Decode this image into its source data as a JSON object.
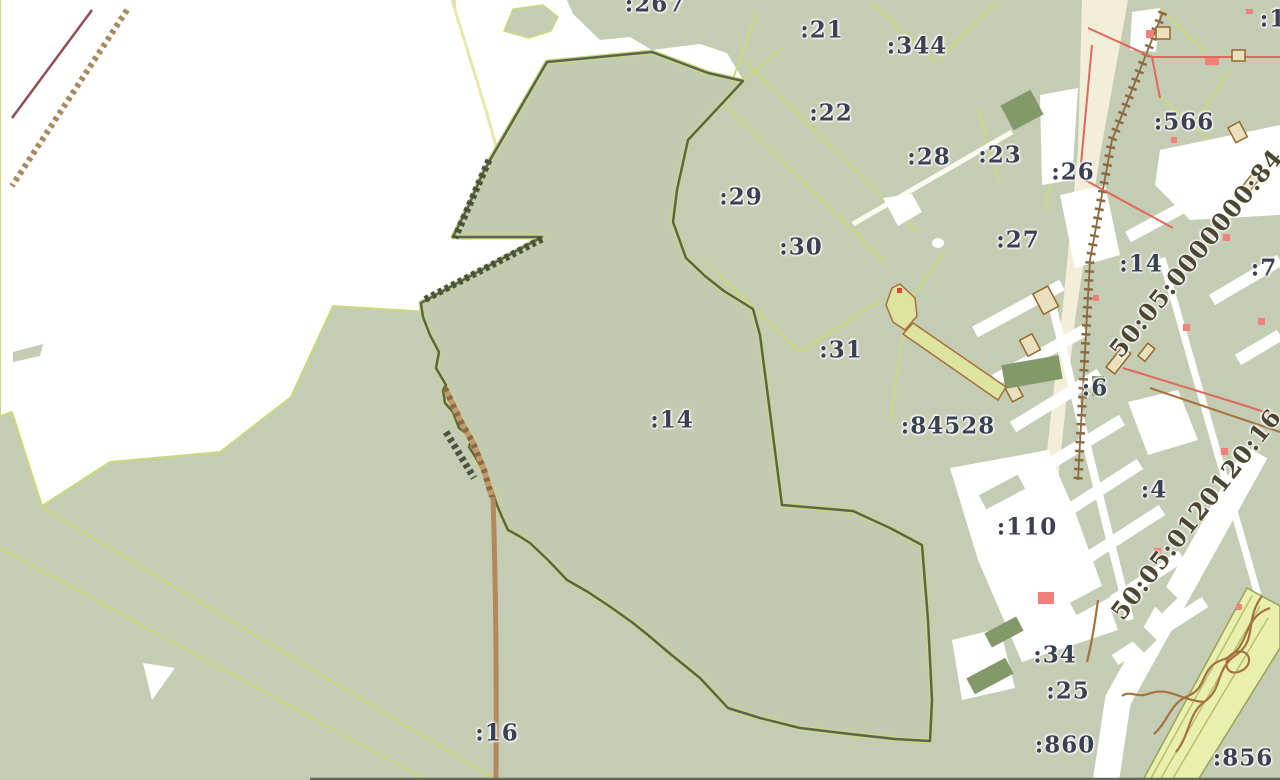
{
  "map": {
    "title": "cadastral-map-view",
    "selected_parcel": ":14",
    "palette": {
      "background": "#ffffff",
      "parcel_fill": "#c5ccb4",
      "parcel_boundary": "#ccd87c",
      "selected_outline": "#5a6354",
      "road_brown": "#b5885c",
      "road_cream": "#f3eed8",
      "railway_maroon": "#8f4e55",
      "building_pink": "#f4807b",
      "building_outline": "#96672e",
      "dark_green_block": "#83996a",
      "wide_band_fill": "#e9efad",
      "pipeline_brown": "#a5713c",
      "label_color": "#3a4153",
      "quarter_label_color": "#4c4733"
    },
    "labels": [
      {
        "text": ":267",
        "x": 655,
        "y": 4
      },
      {
        "text": ":21",
        "x": 822,
        "y": 30
      },
      {
        "text": ":344",
        "x": 917,
        "y": 46
      },
      {
        "text": ":22",
        "x": 831,
        "y": 113
      },
      {
        "text": ":28",
        "x": 929,
        "y": 157
      },
      {
        "text": ":23",
        "x": 1000,
        "y": 155
      },
      {
        "text": ":26",
        "x": 1073,
        "y": 172
      },
      {
        "text": ":566",
        "x": 1184,
        "y": 122
      },
      {
        "text": ":1",
        "x": 1273,
        "y": 19
      },
      {
        "text": ":29",
        "x": 741,
        "y": 197
      },
      {
        "text": ":30",
        "x": 801,
        "y": 247
      },
      {
        "text": ":27",
        "x": 1018,
        "y": 240
      },
      {
        "text": ":14",
        "x": 1141,
        "y": 264
      },
      {
        "text": ":7",
        "x": 1264,
        "y": 268
      },
      {
        "text": ":31",
        "x": 841,
        "y": 350
      },
      {
        "text": ":14",
        "x": 672,
        "y": 420
      },
      {
        "text": ":84528",
        "x": 948,
        "y": 426
      },
      {
        "text": ":6",
        "x": 1095,
        "y": 388
      },
      {
        "text": ":4",
        "x": 1154,
        "y": 490
      },
      {
        "text": ":110",
        "x": 1027,
        "y": 527
      },
      {
        "text": ":34",
        "x": 1055,
        "y": 655
      },
      {
        "text": ":25",
        "x": 1068,
        "y": 691
      },
      {
        "text": ":860",
        "x": 1065,
        "y": 745
      },
      {
        "text": ":856",
        "x": 1243,
        "y": 758
      },
      {
        "text": ":16",
        "x": 497,
        "y": 733
      }
    ],
    "diagonal_labels": [
      {
        "text": "50:05:0000000:84",
        "x": 1196,
        "y": 253,
        "angle": -51
      },
      {
        "text": "50:05:0120120:16",
        "x": 1196,
        "y": 514,
        "angle": -52
      }
    ]
  }
}
